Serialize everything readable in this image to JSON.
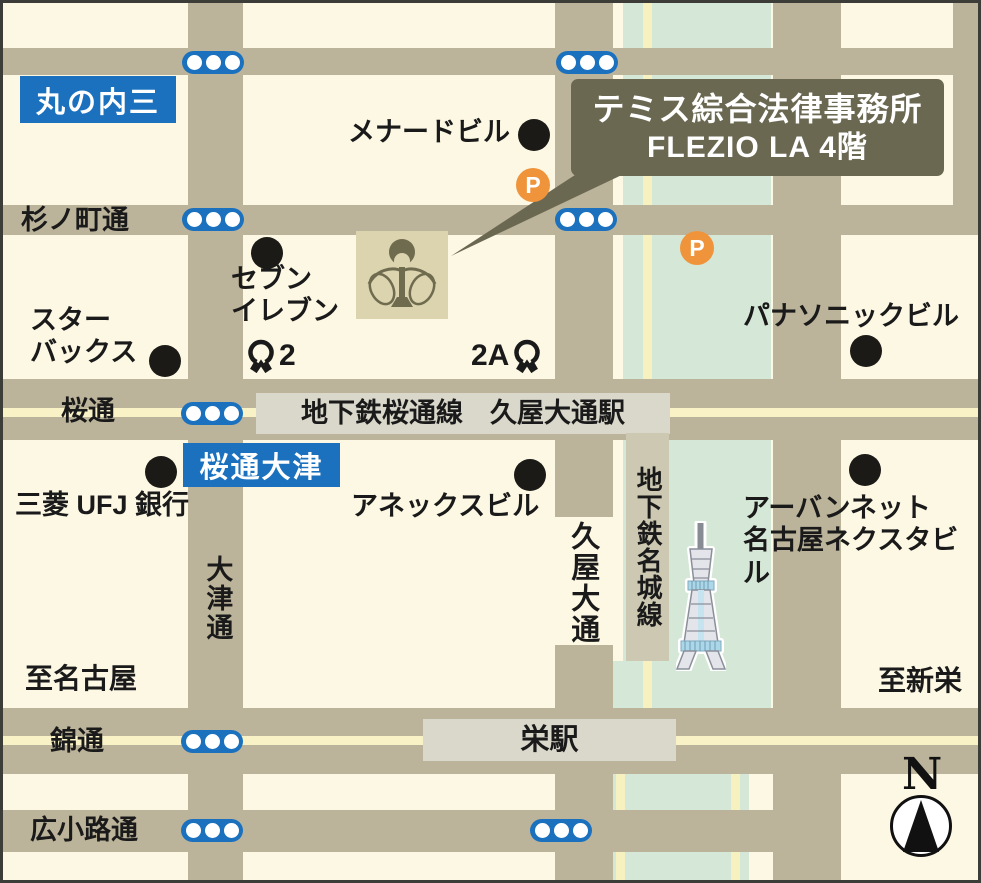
{
  "callout": {
    "line1": "テミス綜合法律事務所",
    "line2": "FLEZIO LA 4階"
  },
  "badges": {
    "marunouchi": "丸の内三",
    "sakuradori_otsu": "桜通大津"
  },
  "streets": {
    "suginomachi": "杉ノ町通",
    "sakuradori": "桜通",
    "nishiki": "錦通",
    "hirokoji": "広小路通",
    "otsudori": "大津通",
    "hisaya_odori": "久屋大通"
  },
  "transit": {
    "sakuradori_line_station": "地下鉄桜通線　久屋大通駅",
    "meijo_line": "地下鉄名城線",
    "sakae_station": "栄駅"
  },
  "pois": [
    {
      "label": "メナードビル"
    },
    {
      "label": "セブン\nイレブン"
    },
    {
      "label": "スター\nバックス"
    },
    {
      "label": "三菱 UFJ 銀行"
    },
    {
      "label": "アネックスビル"
    },
    {
      "label": "パナソニックビル"
    },
    {
      "label": "アーバンネット\n名古屋ネクスタビル"
    }
  ],
  "exits": {
    "exit_2": "2",
    "exit_2a": "2A"
  },
  "directions": {
    "to_nagoya": "至名古屋",
    "to_shinsakae": "至新栄"
  },
  "parking": {
    "label": "P"
  },
  "compass": {
    "label": "N"
  },
  "colors": {
    "background": "#FCF8E4",
    "road": "#BCB49A",
    "park_green": "#D5E7D6",
    "center_line_yellow": "#F8F2C6",
    "station_band_gray": "#DAD7CB",
    "meijo_band_gray": "#CCC8B2",
    "callout_olive": "#6B6852",
    "signal_blue": "#1B71BE",
    "parking_orange": "#F0943C",
    "building_tan": "#DCD3AF",
    "text_black": "#1A1A1A"
  }
}
